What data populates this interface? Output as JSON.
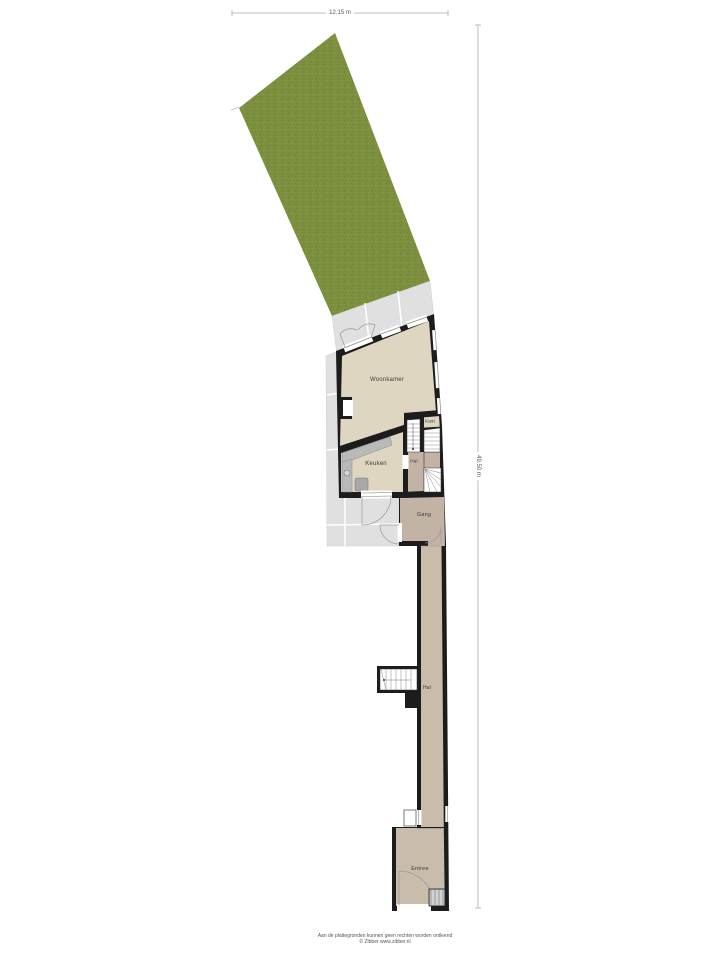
{
  "document": {
    "type": "floorplan-ground-floor-with-garden",
    "background": "#ffffff"
  },
  "dimensions": {
    "width_label": "12.15 m",
    "depth_label": "49.50 m"
  },
  "rooms": [
    {
      "id": "woonkamer",
      "label": "Woonkamer"
    },
    {
      "id": "keuken",
      "label": "Keuken"
    },
    {
      "id": "kast",
      "label": "Kast"
    },
    {
      "id": "hal-midden",
      "label": "Hal"
    },
    {
      "id": "gang",
      "label": "Gang"
    },
    {
      "id": "hal",
      "label": "Hal"
    },
    {
      "id": "entree",
      "label": "Entree"
    }
  ],
  "colors": {
    "garden": "#7c8f3e",
    "garden_dark": "#6e8134",
    "garden_light": "#8a9c4c",
    "paving": "#e0e0e0",
    "paving_seam": "#ffffff",
    "wall": "#1c1c1c",
    "floor_light": "#ded6c0",
    "floor_dark": "#c3b3a4",
    "floor_hall": "#cabcab",
    "counter": "#b9b9b9",
    "stairs": "#ffffff"
  },
  "footer": {
    "disclaimer": "Aan de plattegronden kunnen geen rechten worden ontleend",
    "credit": "© Zibber www.zibber.nl"
  }
}
